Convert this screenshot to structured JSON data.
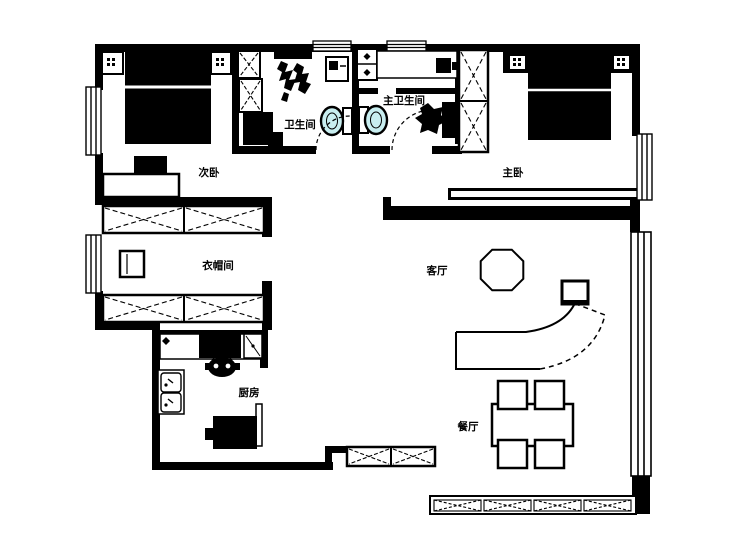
{
  "app": {
    "type": "floor-plan-drawing"
  },
  "rooms": [
    {
      "key": "secondary-bedroom",
      "label": "次卧"
    },
    {
      "key": "master-bedroom",
      "label": "主卧"
    },
    {
      "key": "bathroom",
      "label": "卫生间"
    },
    {
      "key": "master-bathroom",
      "label": "主卫生间"
    },
    {
      "key": "cloakroom",
      "label": "衣帽间"
    },
    {
      "key": "living-room",
      "label": "客厅"
    },
    {
      "key": "kitchen",
      "label": "厨房"
    },
    {
      "key": "dining-room",
      "label": "餐厅"
    }
  ],
  "colors": {
    "wall": "#000000",
    "line": "#000000",
    "toilet_fill": "#c8eef0",
    "background": "#ffffff"
  }
}
